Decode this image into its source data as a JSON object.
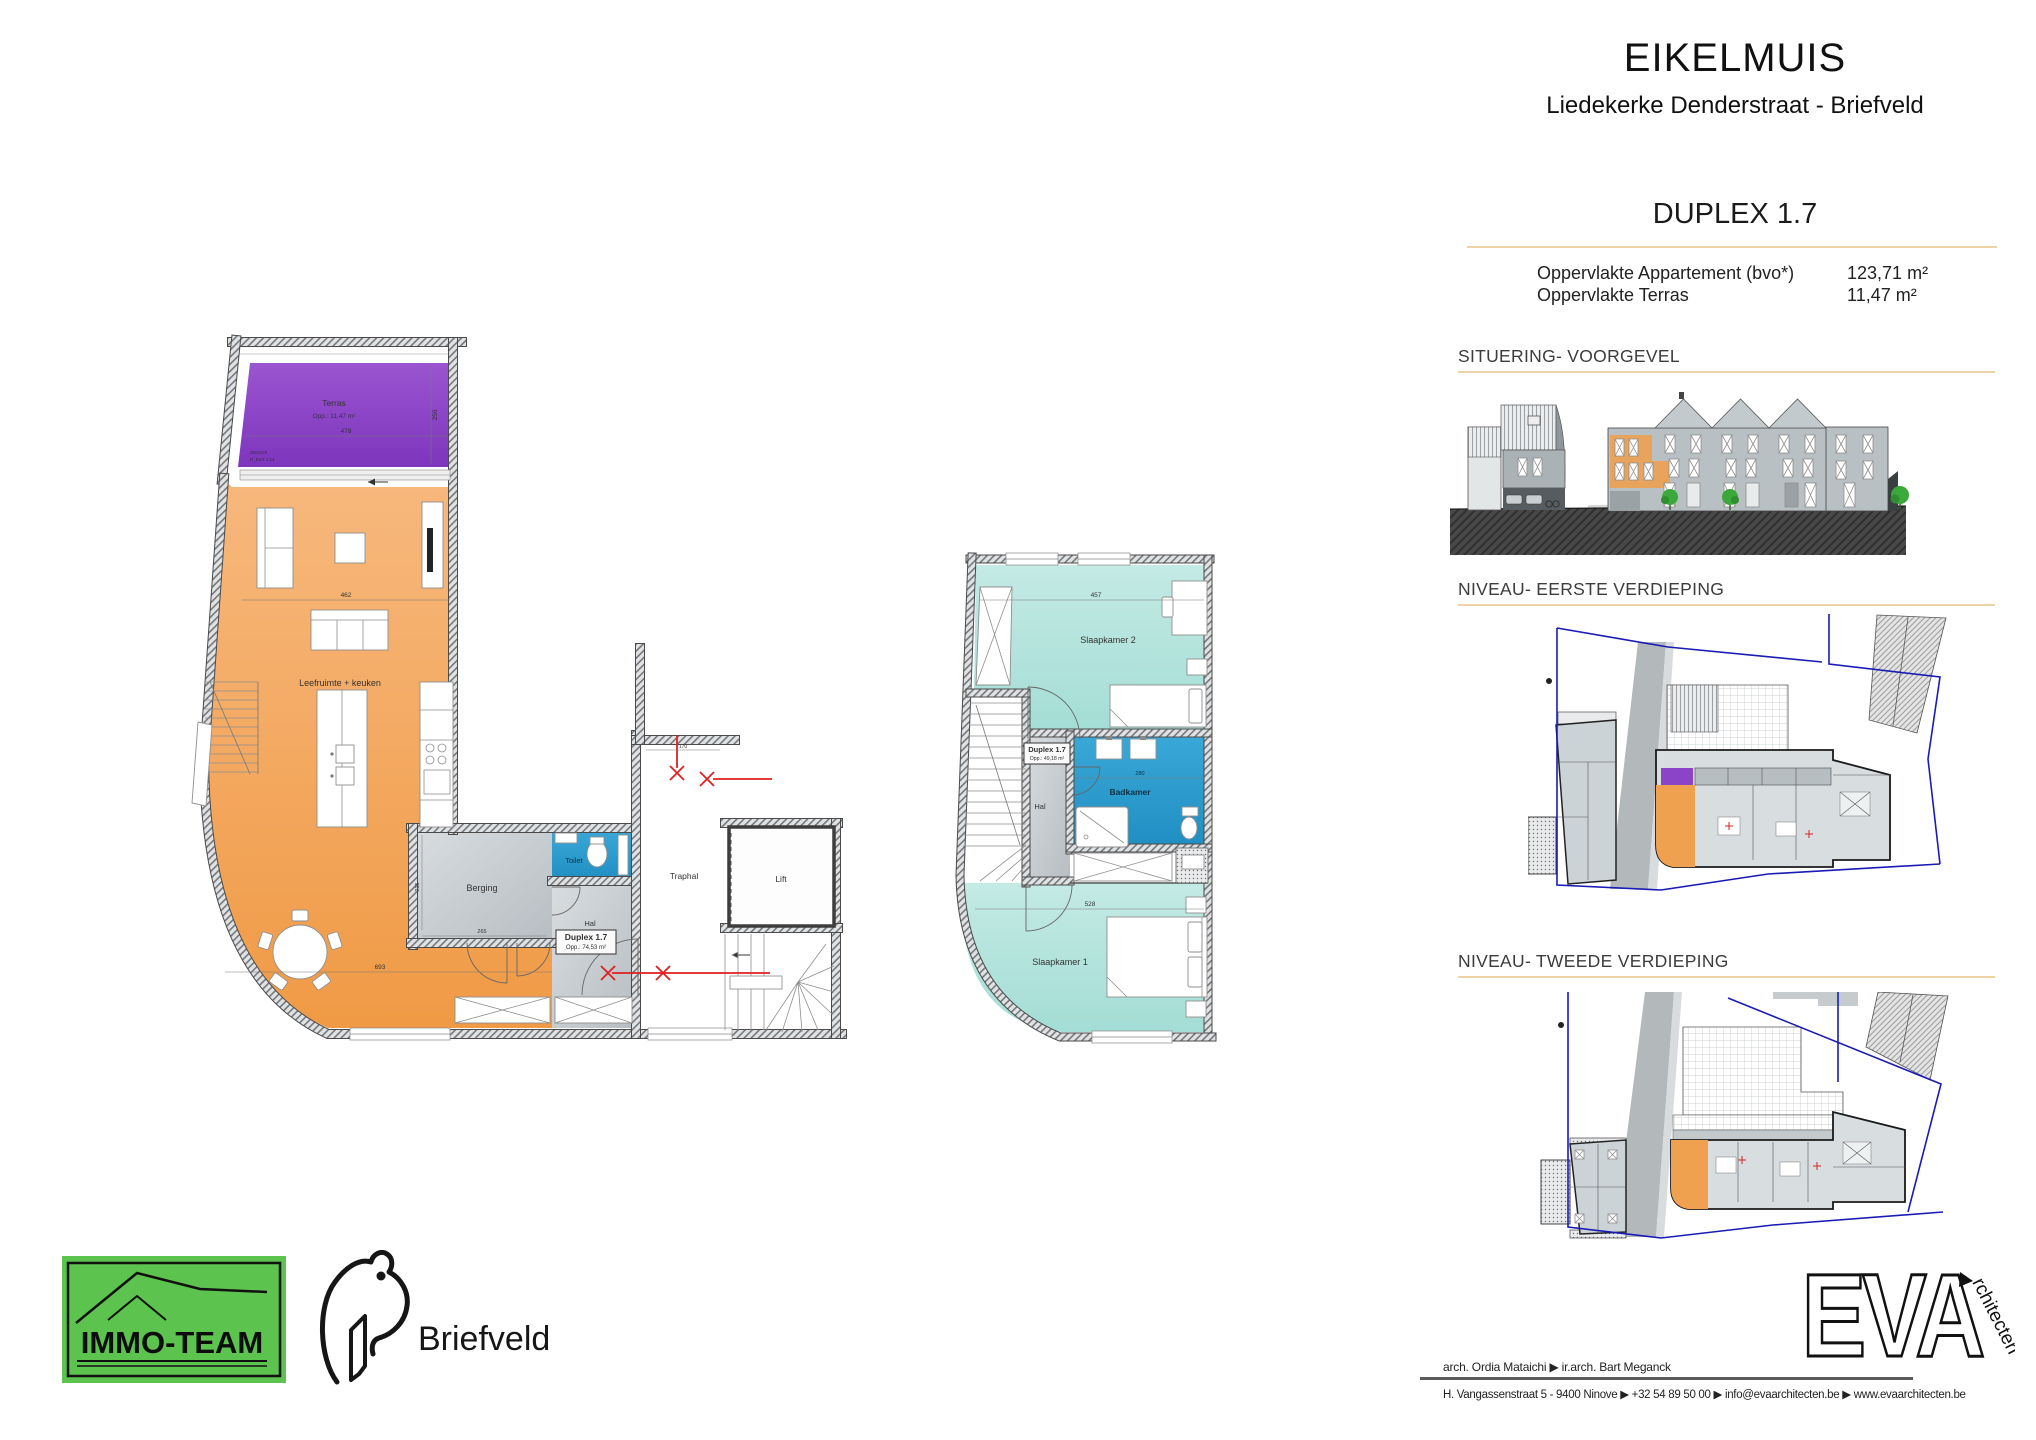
{
  "header": {
    "title": "EIKELMUIS",
    "subtitle": "Liedekerke Denderstraat - Briefveld",
    "unit": "DUPLEX 1.7"
  },
  "areas": {
    "rows": [
      {
        "label": "Oppervlakte Appartement (bvo*)",
        "value": "123,71 m²"
      },
      {
        "label": "Oppervlakte Terras",
        "value": "11,47 m²"
      }
    ]
  },
  "sections": {
    "situering": "SITUERING- VOORGEVEL",
    "niveau1": "NIVEAU- EERSTE VERDIEPING",
    "niveau2": "NIVEAU- TWEEDE VERDIEPING"
  },
  "level1": {
    "terras": {
      "label": "Terras",
      "area": "Opp.: 11,47 m²",
      "dim_w": "478",
      "dim_h": "250",
      "note1": "350x220",
      "note2": "R_BuR 1,14"
    },
    "living": {
      "label": "Leefruimte + keuken",
      "dim_w": "693",
      "dim_mid": "462"
    },
    "berging": {
      "label": "Berging",
      "dim_w": "265",
      "dim_h": "215"
    },
    "toilet": {
      "label": "Toilet"
    },
    "hal": {
      "label": "Hal",
      "tag_title": "Duplex 1.7",
      "tag_area": "Opp.: 74,53 m²"
    },
    "traphal": {
      "label": "Traphal",
      "dim": "170"
    },
    "lift": {
      "label": "Lift"
    }
  },
  "level2": {
    "slaapkamer2": {
      "label": "Slaapkamer 2",
      "dim_w": "457"
    },
    "slaapkamer1": {
      "label": "Slaapkamer 1",
      "dim_w": "528"
    },
    "badkamer": {
      "label": "Badkamer",
      "dim_w": "280"
    },
    "hal": {
      "label": "Hal"
    },
    "tag": {
      "title": "Duplex 1.7",
      "area": "Opp.: 49,18 m²"
    }
  },
  "branding": {
    "immoteam": {
      "label": "IMMO-TEAM"
    },
    "briefveld": {
      "label": "Briefveld"
    },
    "eva": {
      "letters": "EVA",
      "suffix": "rchitecten"
    }
  },
  "footer": {
    "architects": "arch. Ordia Mataichi  ▶  ir.arch. Bart Meganck",
    "contact": "H. Vangassenstraat 5 - 9400 Ninove ▶ +32 54 89 50 00 ▶ info@evaarchitecten.be ▶ www.evaarchitecten.be"
  },
  "colors": {
    "accent_rule": "#eed3a4",
    "terras": "#8b44c8",
    "living": "#f4a45c",
    "bedroom": "#b7e4de",
    "bath": "#2d9fd1",
    "room_gray": "#ccd2d5",
    "immoteam_green": "#5cc34e"
  }
}
